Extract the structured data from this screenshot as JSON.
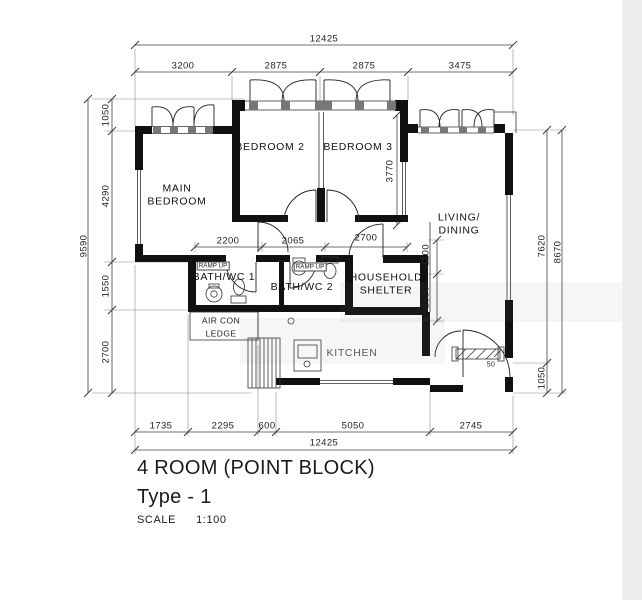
{
  "title_block": {
    "line1": "4 ROOM (POINT BLOCK)",
    "line2": "Type - 1",
    "scale_label": "SCALE",
    "scale_value": "1:100"
  },
  "rooms": {
    "main_bedroom": [
      "MAIN",
      "BEDROOM"
    ],
    "bedroom2": "BEDROOM 2",
    "bedroom3": "BEDROOM 3",
    "living_dining": [
      "LIVING/",
      "DINING"
    ],
    "bath1": "BATH/WC 1",
    "bath2": "BATH/WC 2",
    "household_shelter": [
      "HOUSEHOLD",
      "SHELTER"
    ],
    "aircon_ledge": [
      "AIR CON",
      "LEDGE"
    ],
    "kitchen": "KITCHEN",
    "ramp_up": "RAMP UP"
  },
  "dimensions": {
    "top_total": "12425",
    "top_segments": [
      "3200",
      "2875",
      "2875",
      "3475"
    ],
    "left_total": "9590",
    "left_segments": [
      "1050",
      "4290",
      "1550",
      "2700"
    ],
    "right_inner": "7620",
    "right_outer": "8670",
    "right_bottom": "1050",
    "bottom_segments": [
      "1735",
      "2295",
      "600",
      "5050",
      "2745"
    ],
    "bottom_total": "12425",
    "hall_segments": [
      "2200",
      "2065",
      "2700"
    ],
    "bedroom3_depth": "3770",
    "shelter_side": [
      "1100",
      "1550"
    ],
    "entrance_step": "50"
  },
  "colors": {
    "wall": "#111111",
    "line": "#333333",
    "dim": "#444444"
  }
}
